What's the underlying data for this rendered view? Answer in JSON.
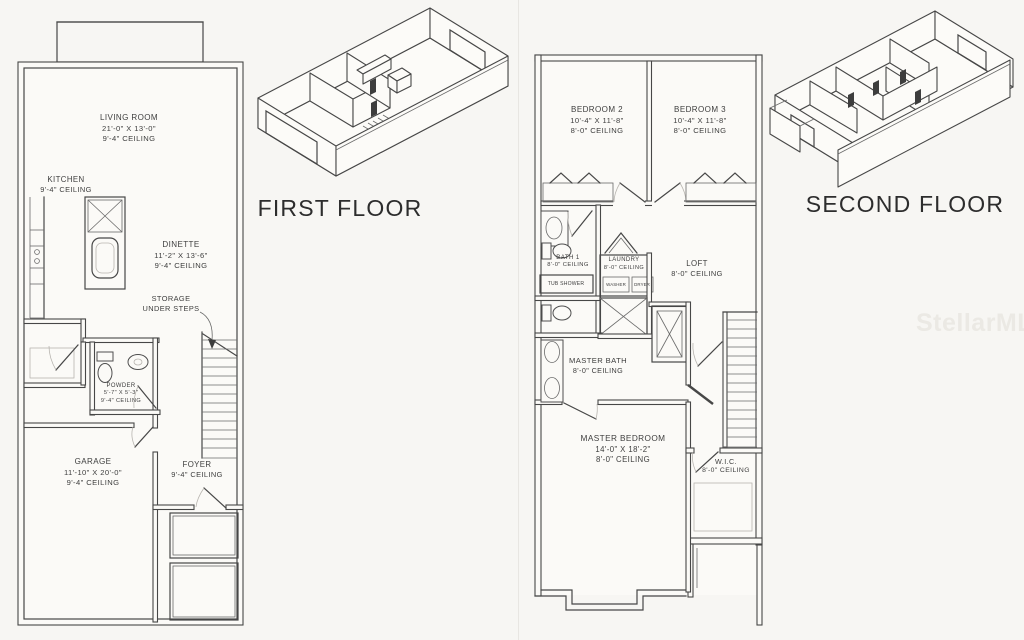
{
  "first_floor": {
    "title": "FIRST FLOOR",
    "living_room": {
      "name": "LIVING ROOM",
      "dims": "21'-0\" X 13'-0\"",
      "ceiling": "9'-4\" CEILING"
    },
    "kitchen": {
      "name": "KITCHEN",
      "ceiling": "9'-4\" CEILING"
    },
    "dinette": {
      "name": "DINETTE",
      "dims": "11'-2\" X 13'-6\"",
      "ceiling": "9'-4\" CEILING"
    },
    "storage": {
      "line1": "STORAGE",
      "line2": "UNDER STEPS"
    },
    "powder": {
      "name": "POWDER",
      "dims": "5'-7\" X 5'-3\"",
      "ceiling": "9'-4\" CEILING"
    },
    "garage": {
      "name": "GARAGE",
      "dims": "11'-10\" X 20'-0\"",
      "ceiling": "9'-4\" CEILING"
    },
    "foyer": {
      "name": "FOYER",
      "ceiling": "9'-4\" CEILING"
    }
  },
  "second_floor": {
    "title": "SECOND FLOOR",
    "bedroom2": {
      "name": "BEDROOM 2",
      "dims": "10'-4\" X 11'-8\"",
      "ceiling": "8'-0\" CEILING"
    },
    "bedroom3": {
      "name": "BEDROOM 3",
      "dims": "10'-4\" X 11'-8\"",
      "ceiling": "8'-0\" CEILING"
    },
    "bath1": {
      "name": "BATH 1",
      "ceiling": "8'-0\" CEILING",
      "tub": "TUB SHOWER"
    },
    "laundry": {
      "name": "LAUNDRY",
      "ceiling": "8'-0\" CEILING",
      "washer": "WASHER",
      "dryer": "DRYER"
    },
    "loft": {
      "name": "LOFT",
      "ceiling": "8'-0\" CEILING"
    },
    "master_bath": {
      "name": "MASTER BATH",
      "ceiling": "8'-0\" CEILING"
    },
    "master_bedroom": {
      "name": "MASTER BEDROOM",
      "dims": "14'-0\" X 18'-2\"",
      "ceiling": "8'-0\" CEILING"
    },
    "wic": {
      "name": "W.I.C.",
      "ceiling": "8'-0\" CEILING"
    }
  },
  "watermark": {
    "text": "StellarMLS"
  },
  "colors": {
    "line": "#474747",
    "background": "#f7f6f3",
    "watermark": "#ebe9e4"
  }
}
